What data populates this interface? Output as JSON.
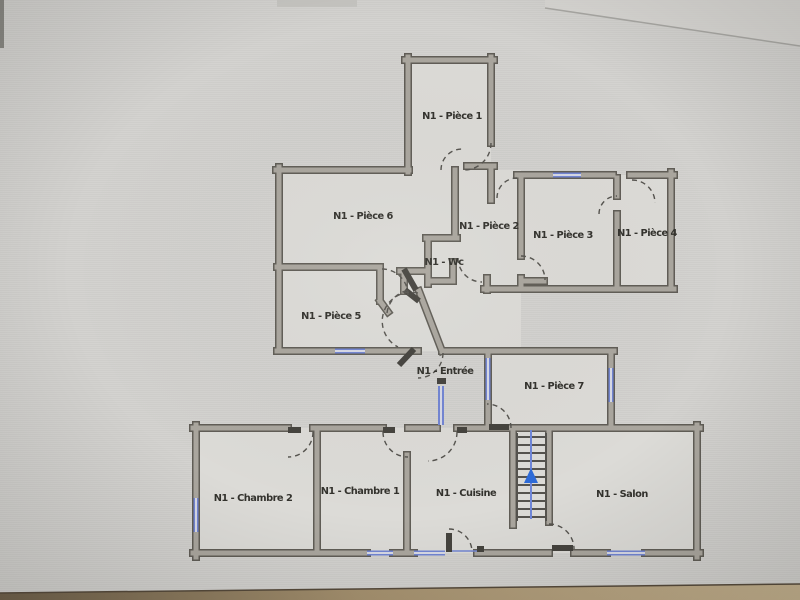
{
  "photo": {
    "type": "floor-plan-photo",
    "floor_prefix": "N1"
  },
  "rooms": [
    {
      "id": "piece-1",
      "label": "N1 - Pièce 1"
    },
    {
      "id": "piece-6",
      "label": "N1 - Pièce 6"
    },
    {
      "id": "piece-2",
      "label": "N1 - Pièce 2"
    },
    {
      "id": "piece-3",
      "label": "N1 - Pièce 3"
    },
    {
      "id": "piece-4",
      "label": "N1 - Pièce 4"
    },
    {
      "id": "wc",
      "label": "N1 - Wc"
    },
    {
      "id": "piece-5",
      "label": "N1 - Pièce 5"
    },
    {
      "id": "entree",
      "label": "N1 - Entrée"
    },
    {
      "id": "piece-7",
      "label": "N1 - Pièce 7"
    },
    {
      "id": "chambre-2",
      "label": "N1 - Chambre 2"
    },
    {
      "id": "chambre-1",
      "label": "N1 - Chambre 1"
    },
    {
      "id": "cuisine",
      "label": "N1 - Cuisine"
    },
    {
      "id": "salon",
      "label": "N1 - Salon"
    }
  ],
  "icons": {
    "stairs_arrow": "up-arrow"
  },
  "colors": {
    "wall_fill": "#aaa69e",
    "wall_outline": "#605d56",
    "window_blue": "#7285d2",
    "entrance_door_blue": "#7285d2",
    "stair_arrow_blue": "#2e6bd8",
    "label_text": "#33322d",
    "paper_background": "#d3d2cf",
    "desk_edge_tan": "#c3b08d"
  }
}
